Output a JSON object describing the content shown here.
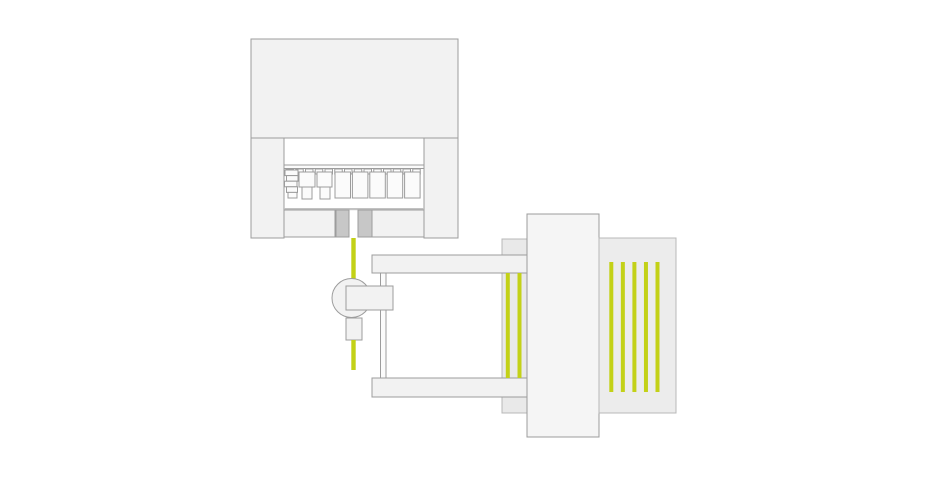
{
  "colors": {
    "background": "#ffffff",
    "machine_fill": "#f2f2f2",
    "machine_stroke": "#9c9c9c",
    "light_stroke": "#b8b8b8",
    "white_fill": "#fbfbfb",
    "dark_block": "#c7c7c7",
    "slab_fill": "#e9e9e9",
    "column_fill": "#f5f5f5",
    "panel_fill": "#ececec",
    "wire_green": "#c3d117",
    "base_line": "#c2c2c2"
  },
  "illustration": {
    "tool_clamp_count": 14,
    "die_count": 5,
    "buffer_wire_count": 2,
    "feed_wire_count": 5
  }
}
